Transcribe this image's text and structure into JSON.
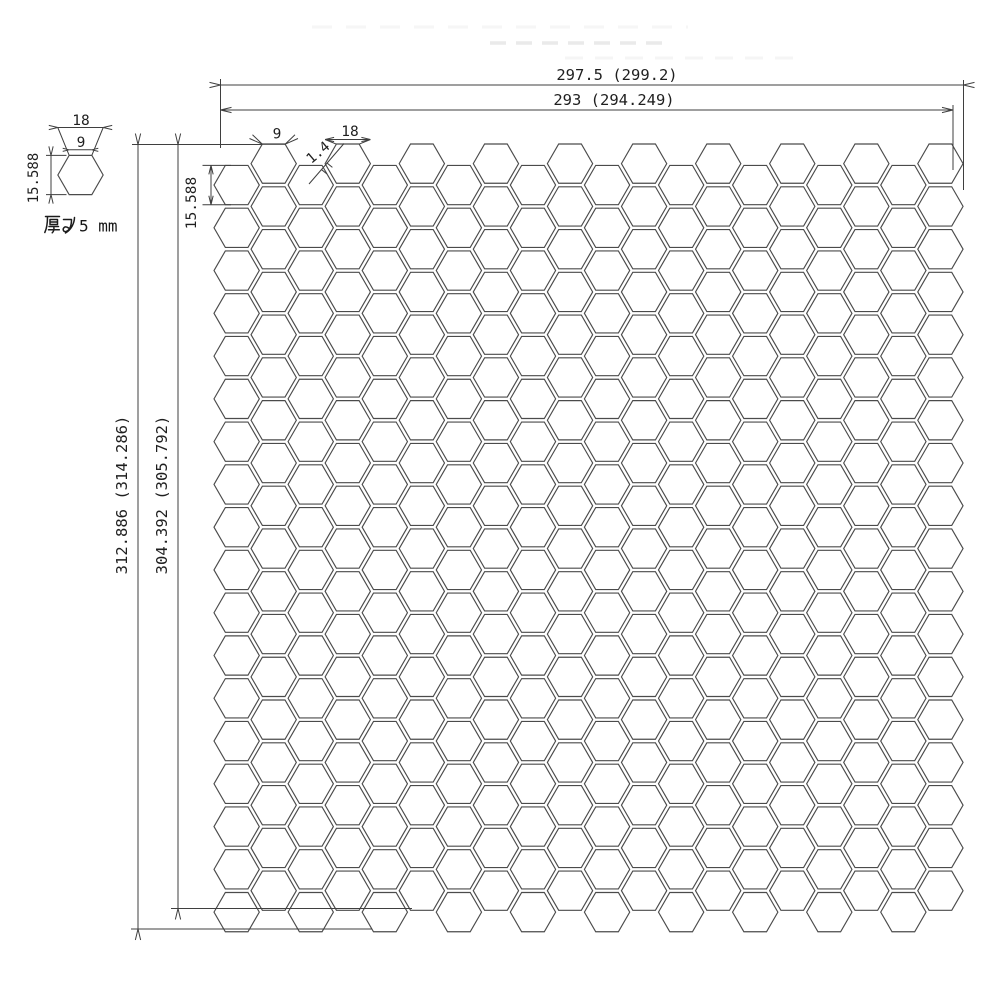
{
  "drawing": {
    "dim_top_outer": "297.5 (299.2)",
    "dim_top_inner": "293 (294.249)",
    "dim_left_outer": "312.886 (314.286)",
    "dim_left_inner": "304.392 (305.792)",
    "dim_first_hex_height": "15.588",
    "dim_hex_top_edge": "9",
    "dim_hex_width": "18",
    "dim_joint_width": "1.4"
  },
  "detail": {
    "dim_width": "18",
    "dim_top_edge": "9",
    "dim_height": "15.588",
    "thickness_label": "厚み 5 mm",
    "thickness_value": "5 mm"
  },
  "grid": {
    "columns": 20,
    "rows_per_column": 18,
    "origin_x": 214,
    "origin_y": 144,
    "hex_width_px": 45.3,
    "hex_height_px": 39.25,
    "col_pitch_px": 37.04,
    "row_pitch_px": 42.77,
    "low_col_offset_px": 21.4,
    "detail_hex": {
      "cx": 80.5,
      "cy": 175
    },
    "stroke_color": "#4b4b4b"
  }
}
